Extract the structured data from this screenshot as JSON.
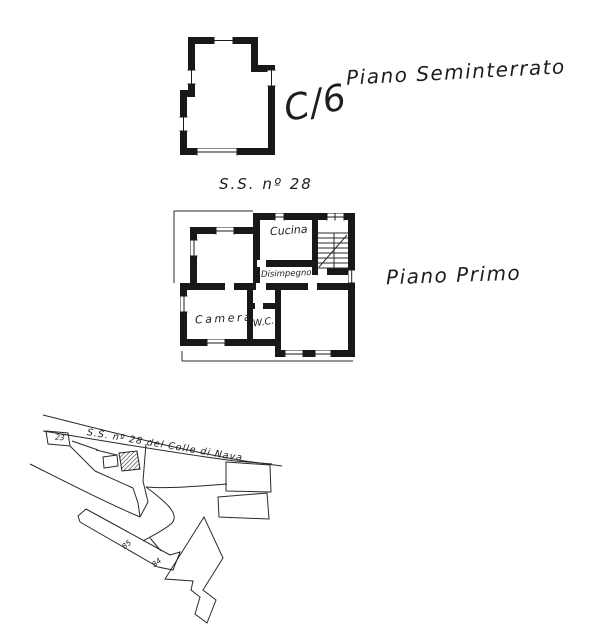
{
  "colors": {
    "ink": "#1f1f1f",
    "paper": "#ffffff"
  },
  "basement": {
    "label": "Piano Seminterrato",
    "annotation": "C/6",
    "caption": "S.S. nº 28"
  },
  "first_floor": {
    "label": "Piano Primo",
    "rooms": {
      "cucina": "Cucina",
      "disimpegno": "Disimpegno",
      "camera": "Camera",
      "wc": "W.C."
    }
  },
  "site_map": {
    "road_label": "S.S. nº 28 del Colle di Nava",
    "parcel_23": "23",
    "parcel_85": "85",
    "parcel_84": "84"
  }
}
